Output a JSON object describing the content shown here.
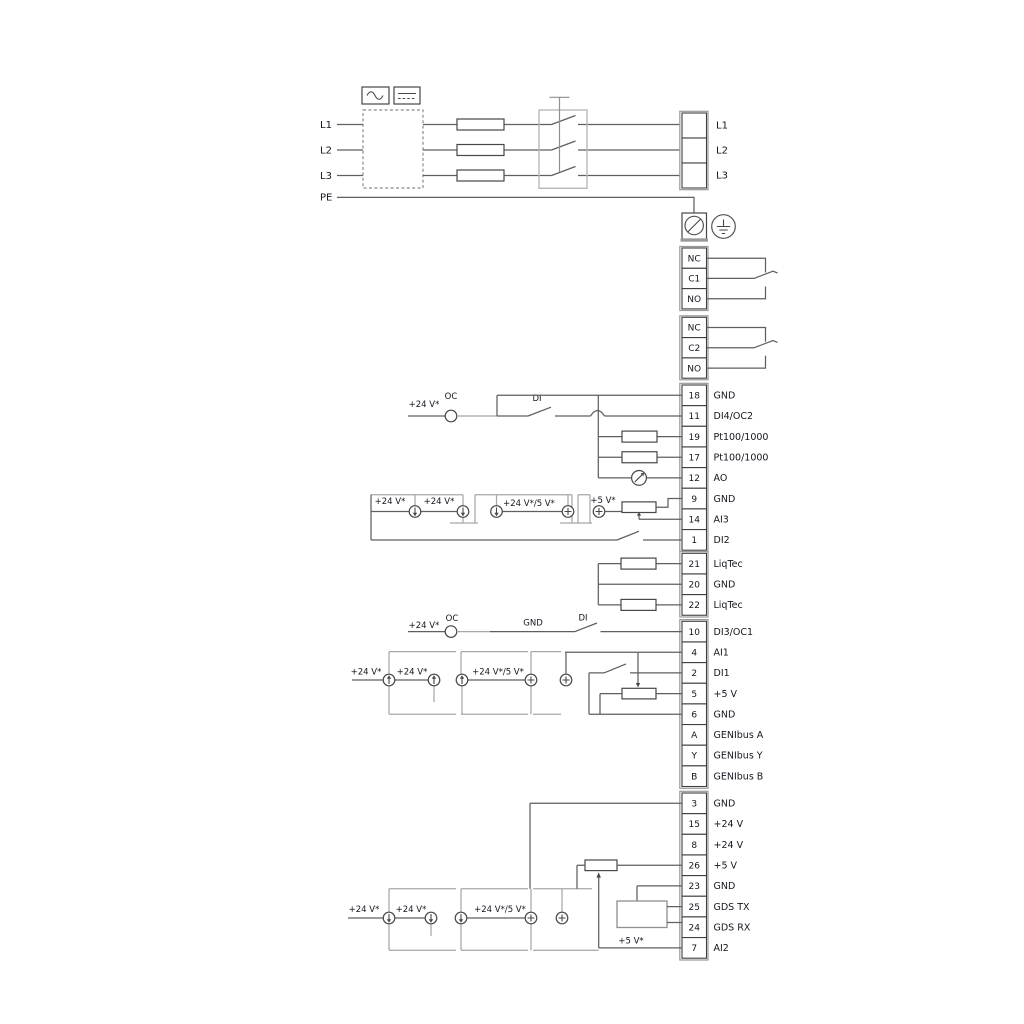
{
  "power": {
    "input_labels": [
      "L1",
      "L2",
      "L3",
      "PE"
    ],
    "output_terminals": [
      "L1",
      "L2",
      "L3"
    ]
  },
  "relay_blocks": [
    {
      "terminals": [
        "NC",
        "C1",
        "NO"
      ]
    },
    {
      "terminals": [
        "NC",
        "C2",
        "NO"
      ]
    }
  ],
  "terminal_groups": [
    {
      "terminals": [
        {
          "id": "18",
          "label": "GND"
        },
        {
          "id": "11",
          "label": "DI4/OC2"
        },
        {
          "id": "19",
          "label": "Pt100/1000"
        },
        {
          "id": "17",
          "label": "Pt100/1000"
        },
        {
          "id": "12",
          "label": "AO"
        },
        {
          "id": "9",
          "label": "GND"
        },
        {
          "id": "14",
          "label": "AI3"
        },
        {
          "id": "1",
          "label": "DI2"
        }
      ]
    },
    {
      "terminals": [
        {
          "id": "21",
          "label": "LiqTec"
        },
        {
          "id": "20",
          "label": "GND"
        },
        {
          "id": "22",
          "label": "LiqTec"
        }
      ]
    },
    {
      "terminals": [
        {
          "id": "10",
          "label": "DI3/OC1"
        },
        {
          "id": "4",
          "label": "AI1"
        },
        {
          "id": "2",
          "label": "DI1"
        },
        {
          "id": "5",
          "label": "+5 V"
        },
        {
          "id": "6",
          "label": "GND"
        },
        {
          "id": "A",
          "label": "GENIbus A"
        },
        {
          "id": "Y",
          "label": "GENIbus Y"
        },
        {
          "id": "B",
          "label": "GENIbus B"
        }
      ]
    },
    {
      "terminals": [
        {
          "id": "3",
          "label": "GND"
        },
        {
          "id": "15",
          "label": "+24 V"
        },
        {
          "id": "8",
          "label": "+24 V"
        },
        {
          "id": "26",
          "label": "+5 V"
        },
        {
          "id": "23",
          "label": "GND"
        },
        {
          "id": "25",
          "label": "GDS TX"
        },
        {
          "id": "24",
          "label": "GDS RX"
        },
        {
          "id": "7",
          "label": "AI2"
        }
      ]
    }
  ],
  "annotations": {
    "di4_supply": "+24 V*",
    "di4_oc": "OC",
    "di4_di": "DI",
    "ai3_supply1": "+24 V*",
    "ai3_supply2": "+24 V*",
    "ai3_supply3": "+24 V*/5 V*",
    "ai3_supply4": "+5 V*",
    "di3_supply": "+24 V*",
    "di3_oc": "OC",
    "di3_gnd": "GND",
    "di3_di": "DI",
    "ai1_supply1": "+24 V*",
    "ai1_supply2": "+24 V*",
    "ai1_supply3": "+24 V*/5 V*",
    "ai2_supply1": "+24 V*",
    "ai2_supply2": "+24 V*",
    "ai2_supply3": "+24 V*/5 V*",
    "gds_supply": "+5 V*"
  }
}
